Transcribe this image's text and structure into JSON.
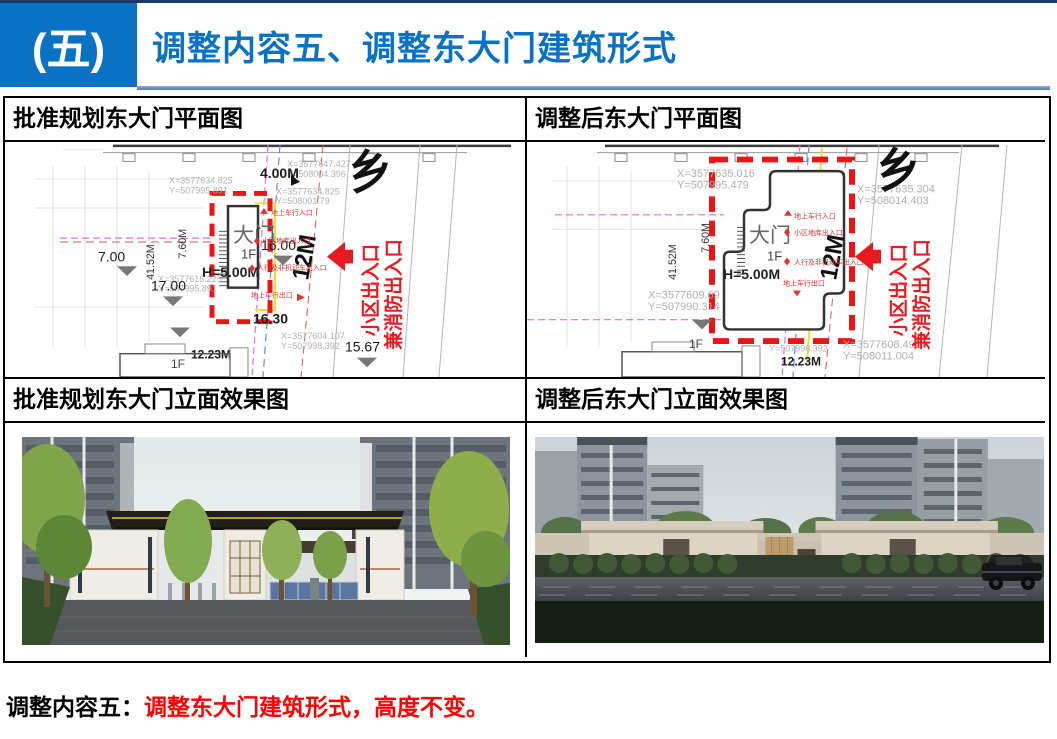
{
  "header": {
    "badge": "(五)",
    "title": "调整内容五、调整东大门建筑形式"
  },
  "panels": {
    "plan_before": {
      "title": "批准规划东大门平面图"
    },
    "plan_after": {
      "title": "调整后东大门平面图"
    },
    "elev_before": {
      "title": "批准规划东大门立面效果图"
    },
    "elev_after": {
      "title": "调整后东大门立面效果图"
    }
  },
  "plan_before": {
    "gate": {
      "name": "大门",
      "floor": "1F",
      "height": "H=5.00M"
    },
    "coords": {
      "c1x": "X=3577634.825",
      "c1y": "Y=507995.891",
      "c2x": "X=3577616.225",
      "c2y": "Y=507995.891",
      "c3x": "X=3577647.427",
      "c3y": "Y=508004.396",
      "c4x": "X=3577634.825",
      "c4y": "Y=508001.79",
      "c5x": "X=3577604.107",
      "c5y": "Y=507998.392"
    },
    "dims": {
      "d1": "4.00M",
      "d2": "7.60M",
      "d3": "41.52M",
      "d4": "7.00",
      "d5": "16.00",
      "d6": "17.00",
      "d7": "16.30",
      "d8": "15.67",
      "d9": "12.23M",
      "road": "12M"
    },
    "labels": {
      "floor": "1F",
      "north": "乡",
      "entry1": "地上车行入口",
      "entry2": "小区地库出入口",
      "entry3": "人行及非机动车出入口",
      "entry4": "地上车行出口",
      "arrow1": "小区出入口",
      "arrow2": "兼消防出入口"
    }
  },
  "plan_after": {
    "gate": {
      "name": "大门",
      "floor": "1F",
      "height": "H=5.00M"
    },
    "coords": {
      "c1x": "X=3577635.016",
      "c1y": "Y=507995.479",
      "c2x": "X=3577635.304",
      "c2y": "Y=508014.403",
      "c3x": "X=3577609.69",
      "c3y": "Y=507990.314",
      "c4x": "X=3577608.491",
      "c4y": "Y=508011.004",
      "c5y": "Y=507998.392"
    },
    "dims": {
      "d2": "7.60M",
      "d3": "41.52M",
      "d9": "12.23M",
      "road": "12M"
    },
    "labels": {
      "floor": "1F",
      "north": "乡",
      "entry1": "地上车行入口",
      "entry2": "小区地库出入口",
      "entry3": "人行及非机动车出入口",
      "entry4": "地上车行出口",
      "arrow1": "小区出入口",
      "arrow2": "兼消防出入口"
    }
  },
  "footer": {
    "label": "调整内容五：",
    "text": "调整东大门建筑形式，高度不变。"
  },
  "colors": {
    "accent_blue": "#0A72C4",
    "rule_blue": "#5B84B8",
    "highlight_red": "#EE1414",
    "caption_red": "#FF0000"
  }
}
